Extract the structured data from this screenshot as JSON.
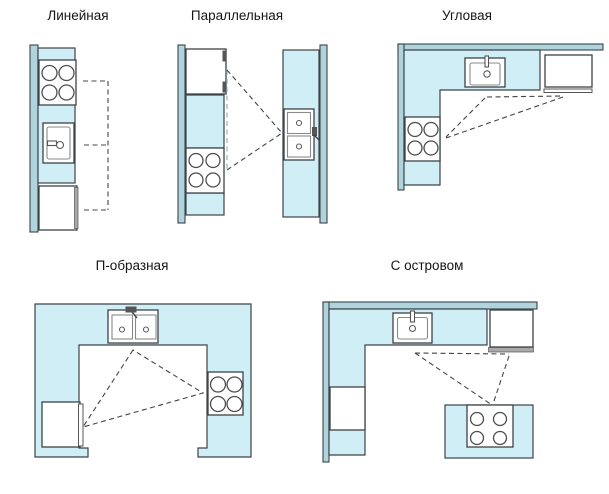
{
  "figure": {
    "background": "#ffffff",
    "description": "Five kitchen layout plan types with dashed work-triangle connectors"
  },
  "palette": {
    "counter": "#cfeef6",
    "wall": "#b0d4de",
    "outline": "#3d4347",
    "appliance": "#ffffff",
    "graybar": "#a9a9a9",
    "dash": "#444444",
    "dashlight": "#a9b4b8",
    "text": "#151515"
  },
  "diagrams": [
    {
      "id": "linear",
      "title": "Линейная",
      "connector": "line",
      "elements": [
        "wall",
        "counter",
        "stove",
        "sink",
        "refrigerator"
      ]
    },
    {
      "id": "parallel",
      "title": "Параллельная",
      "connector": "triangle",
      "elements": [
        "wall-left",
        "wall-right",
        "counter-left",
        "counter-right",
        "refrigerator",
        "stove",
        "double-sink"
      ]
    },
    {
      "id": "corner",
      "title": "Угловая",
      "connector": "triangle",
      "elements": [
        "wall",
        "l-counter",
        "sink",
        "refrigerator",
        "stove"
      ]
    },
    {
      "id": "u-shaped",
      "title": "П-образная",
      "connector": "triangle",
      "elements": [
        "u-counter",
        "double-sink",
        "refrigerator",
        "stove"
      ]
    },
    {
      "id": "island",
      "title": "С островом",
      "connector": "triangle",
      "elements": [
        "wall",
        "l-counter",
        "sink",
        "refrigerator",
        "dishwasher",
        "island-stove"
      ]
    }
  ]
}
